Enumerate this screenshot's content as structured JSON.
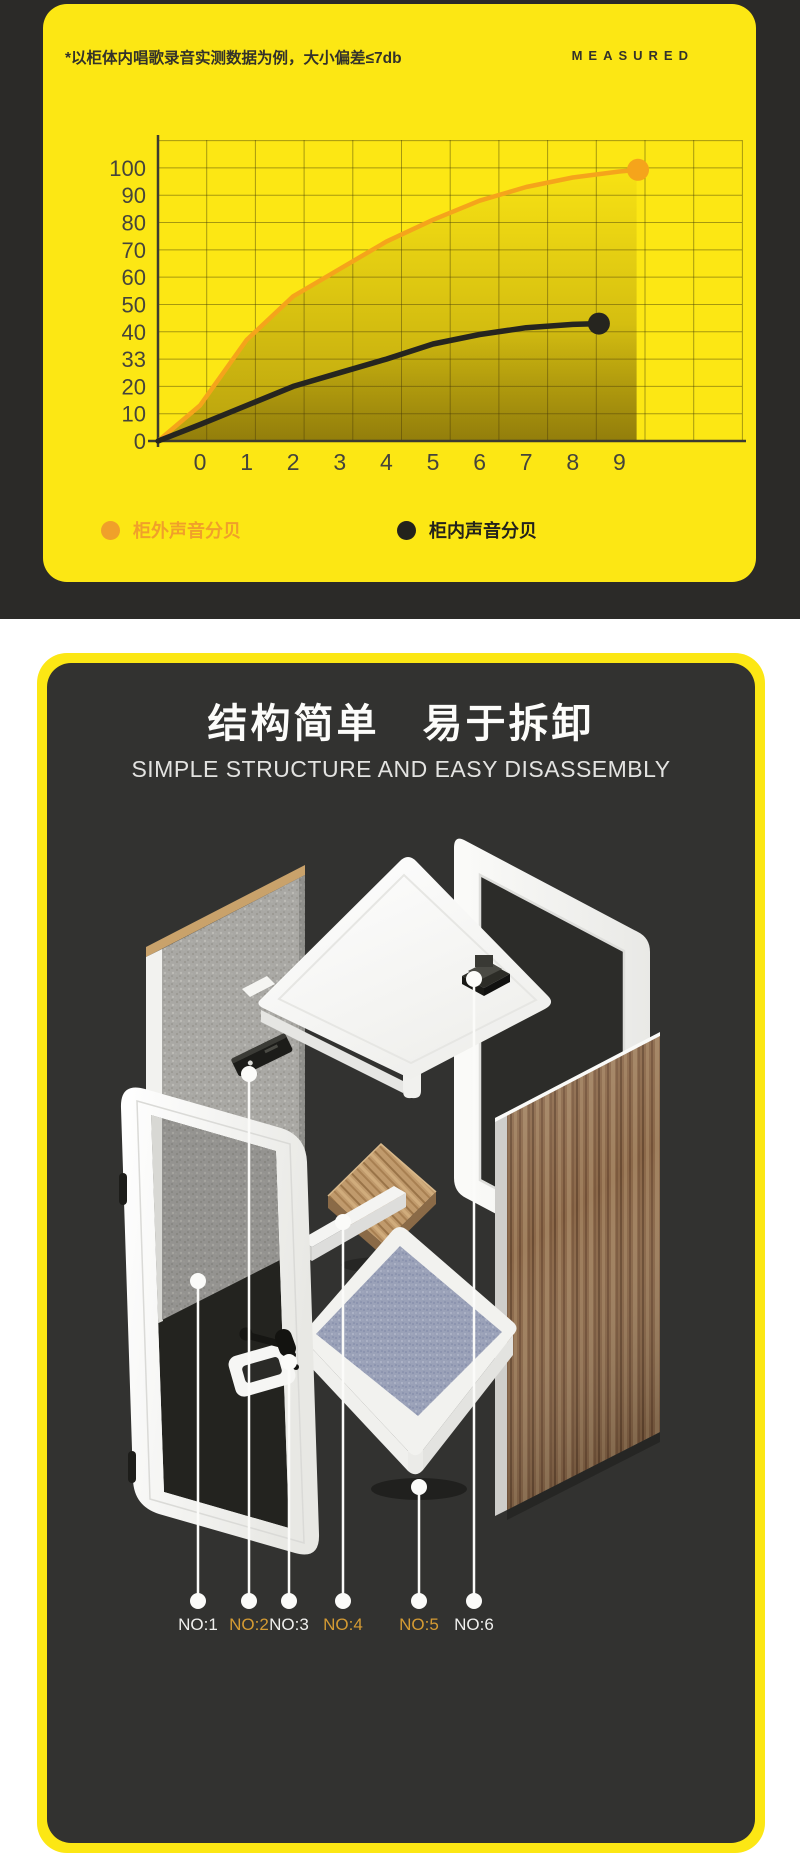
{
  "measurement_card": {
    "note": "*以柜体内唱歌录音实测数据为例，大小偏差≤7db",
    "badge": "MEASURED",
    "card_color": "#fce714",
    "legend": [
      {
        "label": "柜外声音分贝",
        "color": "#f0a02a"
      },
      {
        "label": "柜内声音分贝",
        "color": "#23221c"
      }
    ]
  },
  "chart_data": {
    "type": "line",
    "title": "",
    "xlabel": "",
    "ylabel": "",
    "x_ticks": [
      "0",
      "1",
      "2",
      "3",
      "4",
      "5",
      "6",
      "7",
      "8",
      "9"
    ],
    "y_tick_labels": [
      "0",
      "10",
      "20",
      "33",
      "40",
      "50",
      "60",
      "70",
      "80",
      "90",
      "100"
    ],
    "y_tick_values": [
      0,
      10,
      20,
      30,
      40,
      50,
      60,
      70,
      80,
      90,
      100
    ],
    "ylim": [
      0,
      110
    ],
    "grid": true,
    "legend_position": "bottom",
    "shaded_area_right_x": 9.37,
    "series": [
      {
        "name": "柜外声音分贝",
        "color": "#f5a41b",
        "points": [
          [
            -0.9,
            0
          ],
          [
            0,
            13
          ],
          [
            1,
            37
          ],
          [
            2,
            53
          ],
          [
            3,
            63
          ],
          [
            4,
            73
          ],
          [
            5,
            81
          ],
          [
            6,
            88
          ],
          [
            7,
            93
          ],
          [
            8,
            96.5
          ],
          [
            9,
            98.7
          ],
          [
            9.4,
            99.3
          ]
        ]
      },
      {
        "name": "柜内声音分贝",
        "color": "#26251f",
        "points": [
          [
            -0.9,
            0
          ],
          [
            0,
            6
          ],
          [
            1,
            13
          ],
          [
            2,
            20
          ],
          [
            3,
            25
          ],
          [
            4,
            30
          ],
          [
            5,
            35.5
          ],
          [
            6,
            39
          ],
          [
            7,
            41.5
          ],
          [
            8,
            42.7
          ],
          [
            8.56,
            43
          ]
        ]
      }
    ]
  },
  "structure_card": {
    "title": "结构简单　易于拆卸",
    "subtitle": "SIMPLE STRUCTURE AND EASY DISASSEMBLY",
    "parts": [
      {
        "label": "NO:1",
        "color": "#f0f0ee"
      },
      {
        "label": "NO:2",
        "color": "#d59b33"
      },
      {
        "label": "NO:3",
        "color": "#f0f0ee"
      },
      {
        "label": "NO:4",
        "color": "#d59b33"
      },
      {
        "label": "NO:5",
        "color": "#d59b33"
      },
      {
        "label": "NO:6",
        "color": "#f0f0ee"
      }
    ]
  }
}
